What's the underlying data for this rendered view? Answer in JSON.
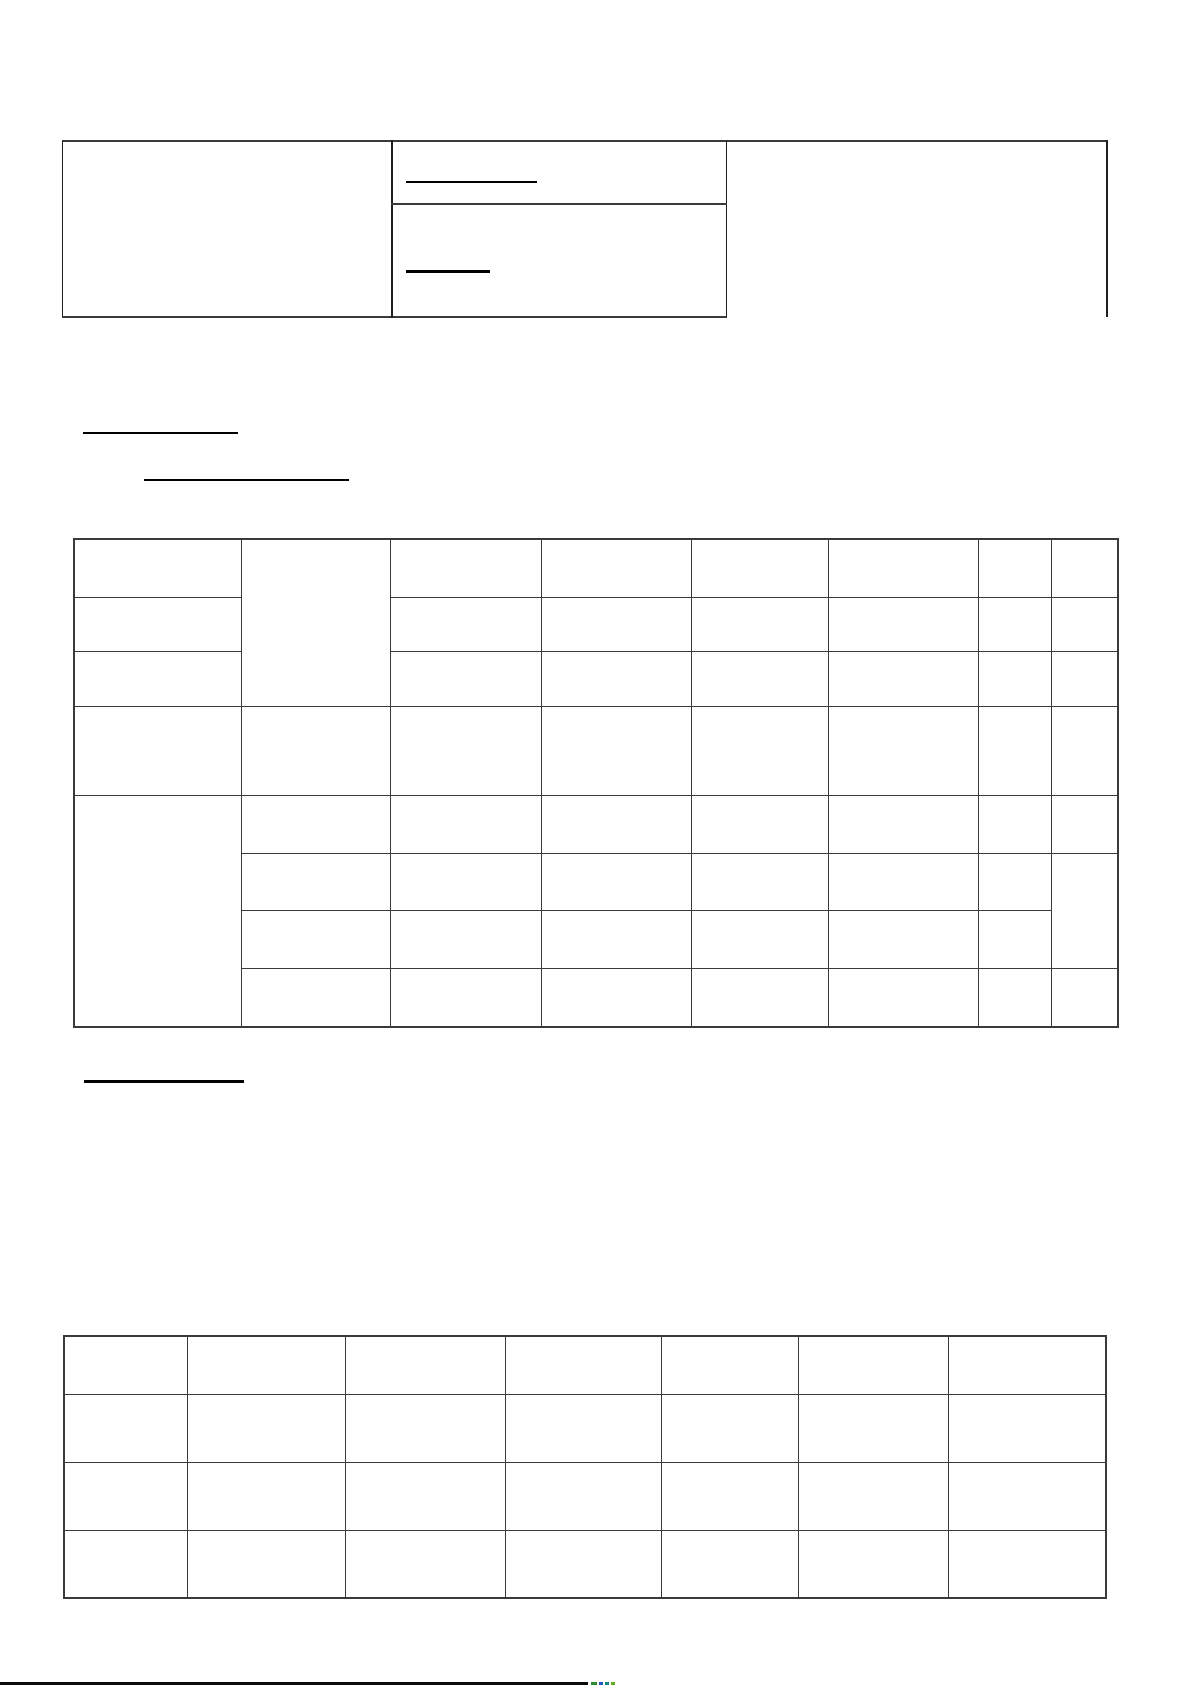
{
  "page": {
    "width": 1191,
    "height": 1685,
    "background": "#ffffff"
  },
  "colors": {
    "grid_line": "#3a3a3a",
    "thin_line": "#1f1f1f",
    "underline": "#000000",
    "edge_bar": "#0a0a0a"
  },
  "top_form": {
    "box": {
      "x": 62,
      "y": 140,
      "width": 665,
      "height": 178
    },
    "vertical_divider_x": 391,
    "horizontal_divider": {
      "x1": 391,
      "x2": 727,
      "y": 203
    },
    "top_border_extension": {
      "x1": 727,
      "x2": 1106,
      "y": 140
    },
    "right_border": {
      "x": 1106,
      "y1": 140,
      "y2": 317
    },
    "underlines": [
      {
        "x": 406,
        "y": 181,
        "width": 131,
        "thickness": 2
      },
      {
        "x": 406,
        "y": 270,
        "width": 84,
        "thickness": 3
      }
    ]
  },
  "blank_underlines": [
    {
      "x": 83,
      "y": 432,
      "width": 155,
      "thickness": 2
    },
    {
      "x": 144,
      "y": 479,
      "width": 205,
      "thickness": 2
    },
    {
      "x": 84,
      "y": 1080,
      "width": 160,
      "thickness": 3
    }
  ],
  "tables": [
    {
      "name": "main-table",
      "x": 73,
      "y": 538,
      "col_widths": [
        167,
        149,
        151,
        150,
        137,
        150,
        73,
        67
      ],
      "row_heights": [
        58,
        54,
        55,
        89,
        58,
        57,
        58,
        59
      ],
      "merges": [
        {
          "row": 0,
          "col": 1,
          "rowspan": 3,
          "colspan": 1
        },
        {
          "row": 4,
          "col": 0,
          "rowspan": 4,
          "colspan": 1
        },
        {
          "row": 5,
          "col": 7,
          "rowspan": 2,
          "colspan": 1
        }
      ]
    },
    {
      "name": "bottom-table",
      "x": 63,
      "y": 1335,
      "col_widths": [
        123,
        158,
        160,
        156,
        137,
        150,
        158
      ],
      "row_heights": [
        58,
        68,
        68,
        68
      ],
      "merges": []
    }
  ],
  "page_edge": {
    "bar": {
      "x": 0,
      "y": 1682,
      "width": 588,
      "height": 3
    },
    "specks": [
      {
        "x": 591,
        "y": 1682,
        "width": 6,
        "height": 3,
        "color": "#2e8b2e"
      },
      {
        "x": 599,
        "y": 1682,
        "width": 4,
        "height": 3,
        "color": "#2255cc"
      },
      {
        "x": 605,
        "y": 1682,
        "width": 4,
        "height": 3,
        "color": "#11857f"
      },
      {
        "x": 611,
        "y": 1682,
        "width": 4,
        "height": 3,
        "color": "#66aa22"
      }
    ]
  }
}
